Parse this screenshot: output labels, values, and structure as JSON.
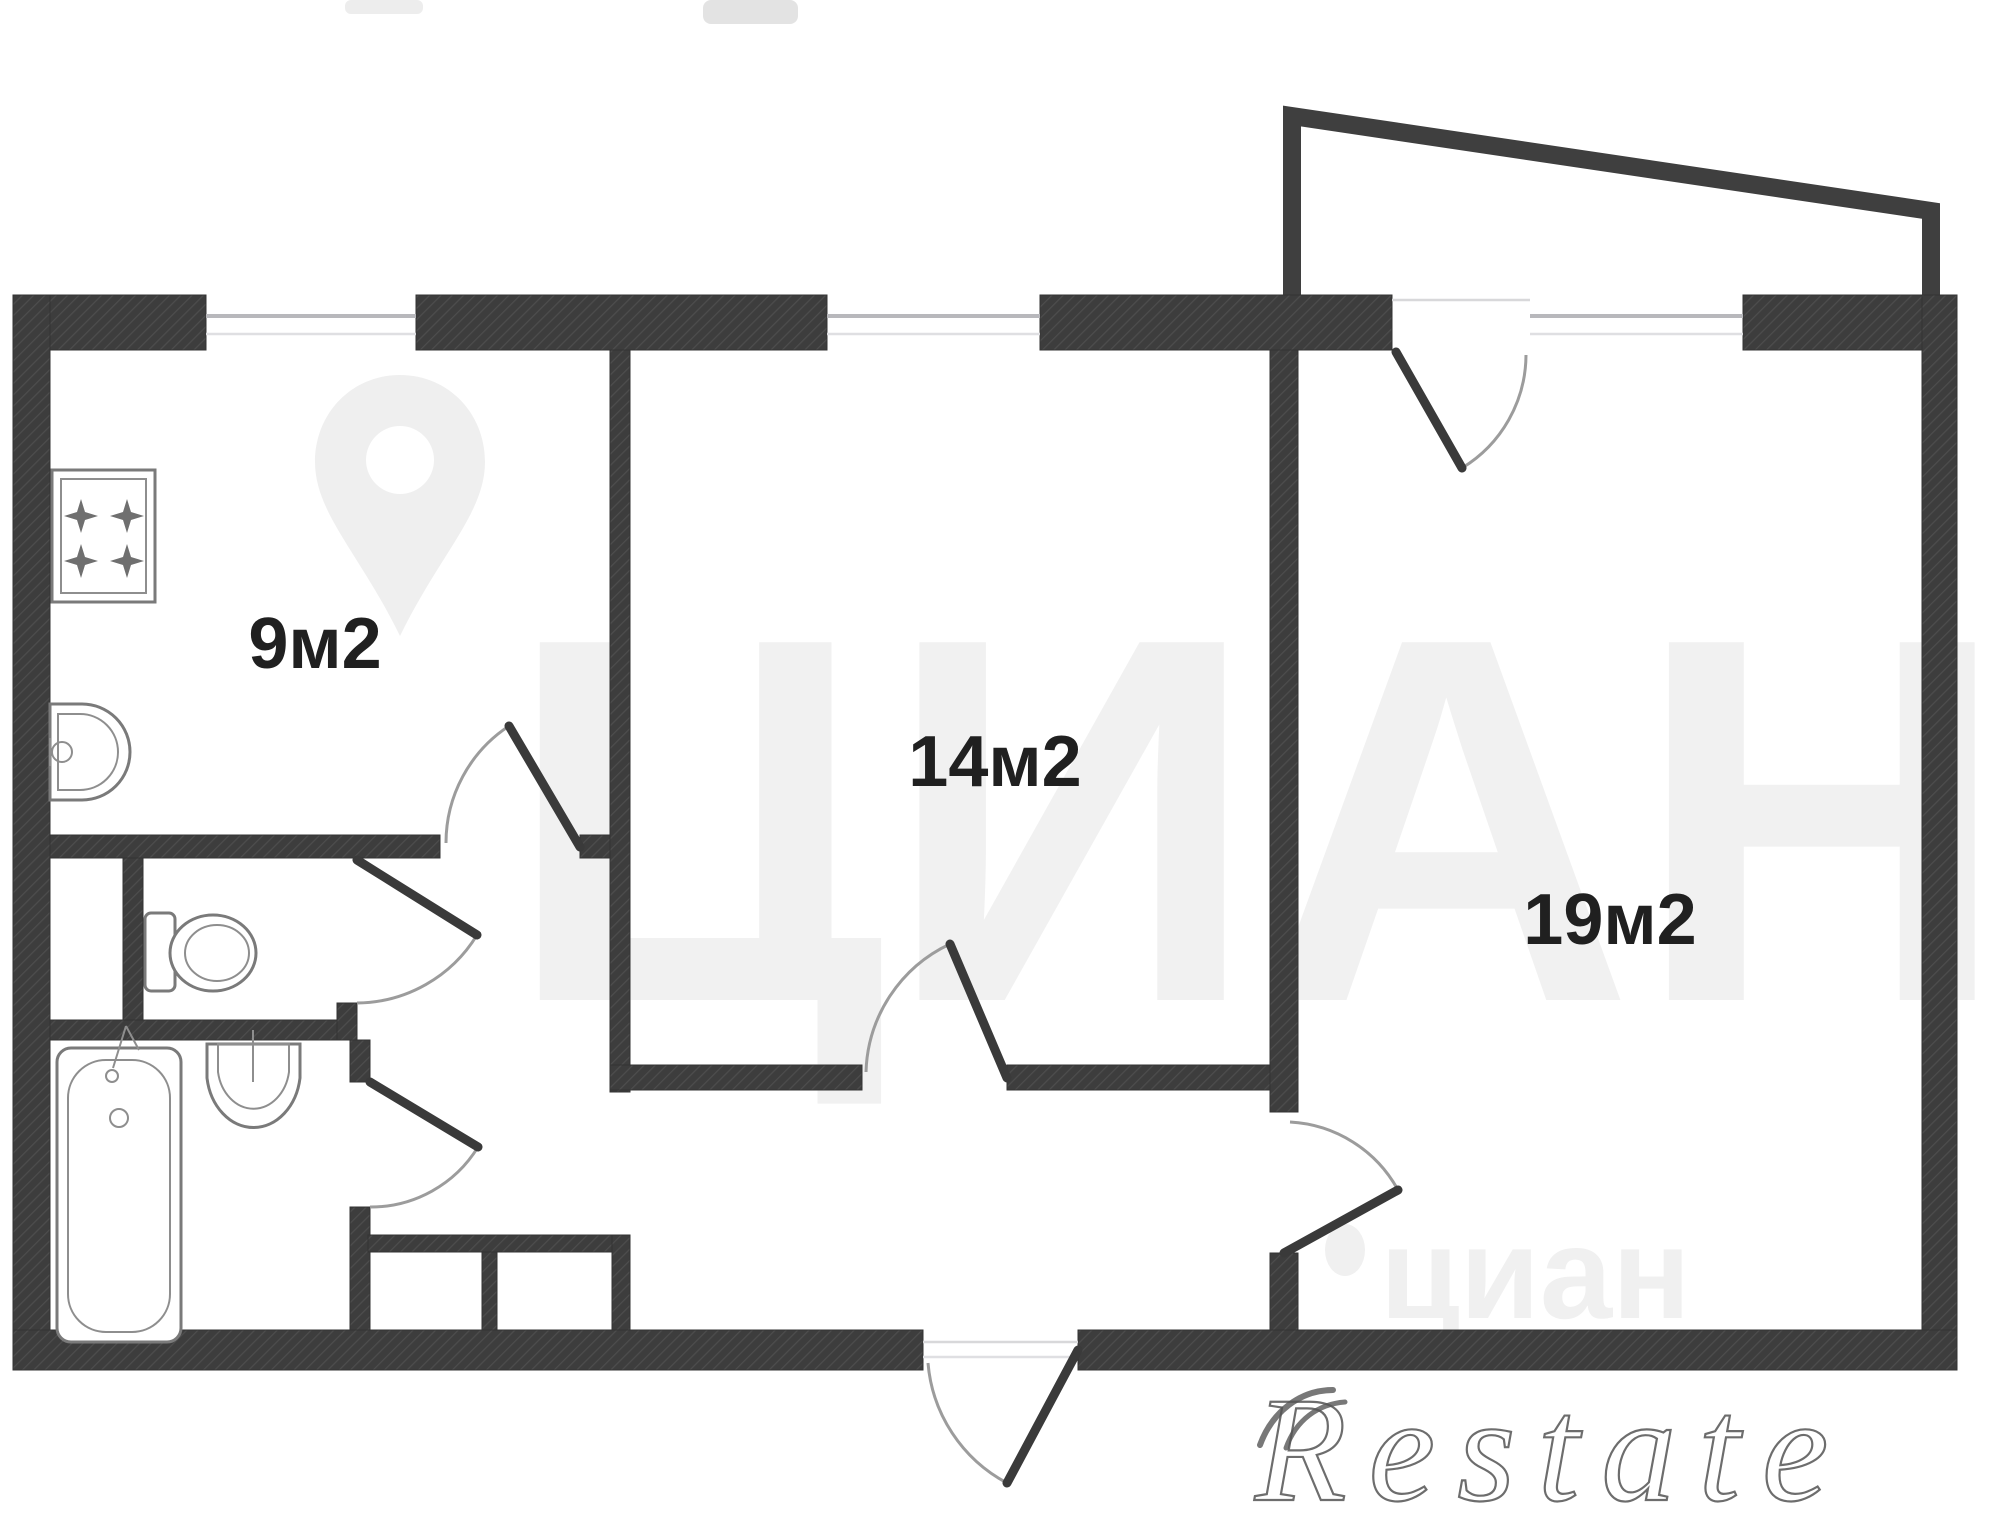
{
  "rooms": [
    {
      "id": "kitchen",
      "area_label": "9м2"
    },
    {
      "id": "room_14",
      "area_label": "14м2"
    },
    {
      "id": "room_19",
      "area_label": "19м2"
    }
  ],
  "fixtures": [
    {
      "name": "stove"
    },
    {
      "name": "kitchen-sink"
    },
    {
      "name": "toilet"
    },
    {
      "name": "washbasin"
    },
    {
      "name": "bathtub"
    }
  ],
  "doors": [
    {
      "name": "kitchen-door"
    },
    {
      "name": "wc-door"
    },
    {
      "name": "bathroom-door"
    },
    {
      "name": "room-14-door"
    },
    {
      "name": "room-19-door"
    },
    {
      "name": "balcony-door"
    },
    {
      "name": "entrance-door"
    }
  ],
  "watermarks": {
    "brand_large": "ЦИАН",
    "brand_small": "циан",
    "agency": "Restate"
  },
  "colors": {
    "wall": "#3d3d3d",
    "wall_hatch": "#4d4d4d",
    "room_label": "#202020",
    "door_leaf": "#3a3a3a",
    "door_arc": "#9c9c9c",
    "window_frame": "#b8b8bc",
    "fixture_outline": "#7a7a7a",
    "watermark_light": "#f1f1f1",
    "restate_outline": "#545454",
    "background": "#ffffff"
  }
}
